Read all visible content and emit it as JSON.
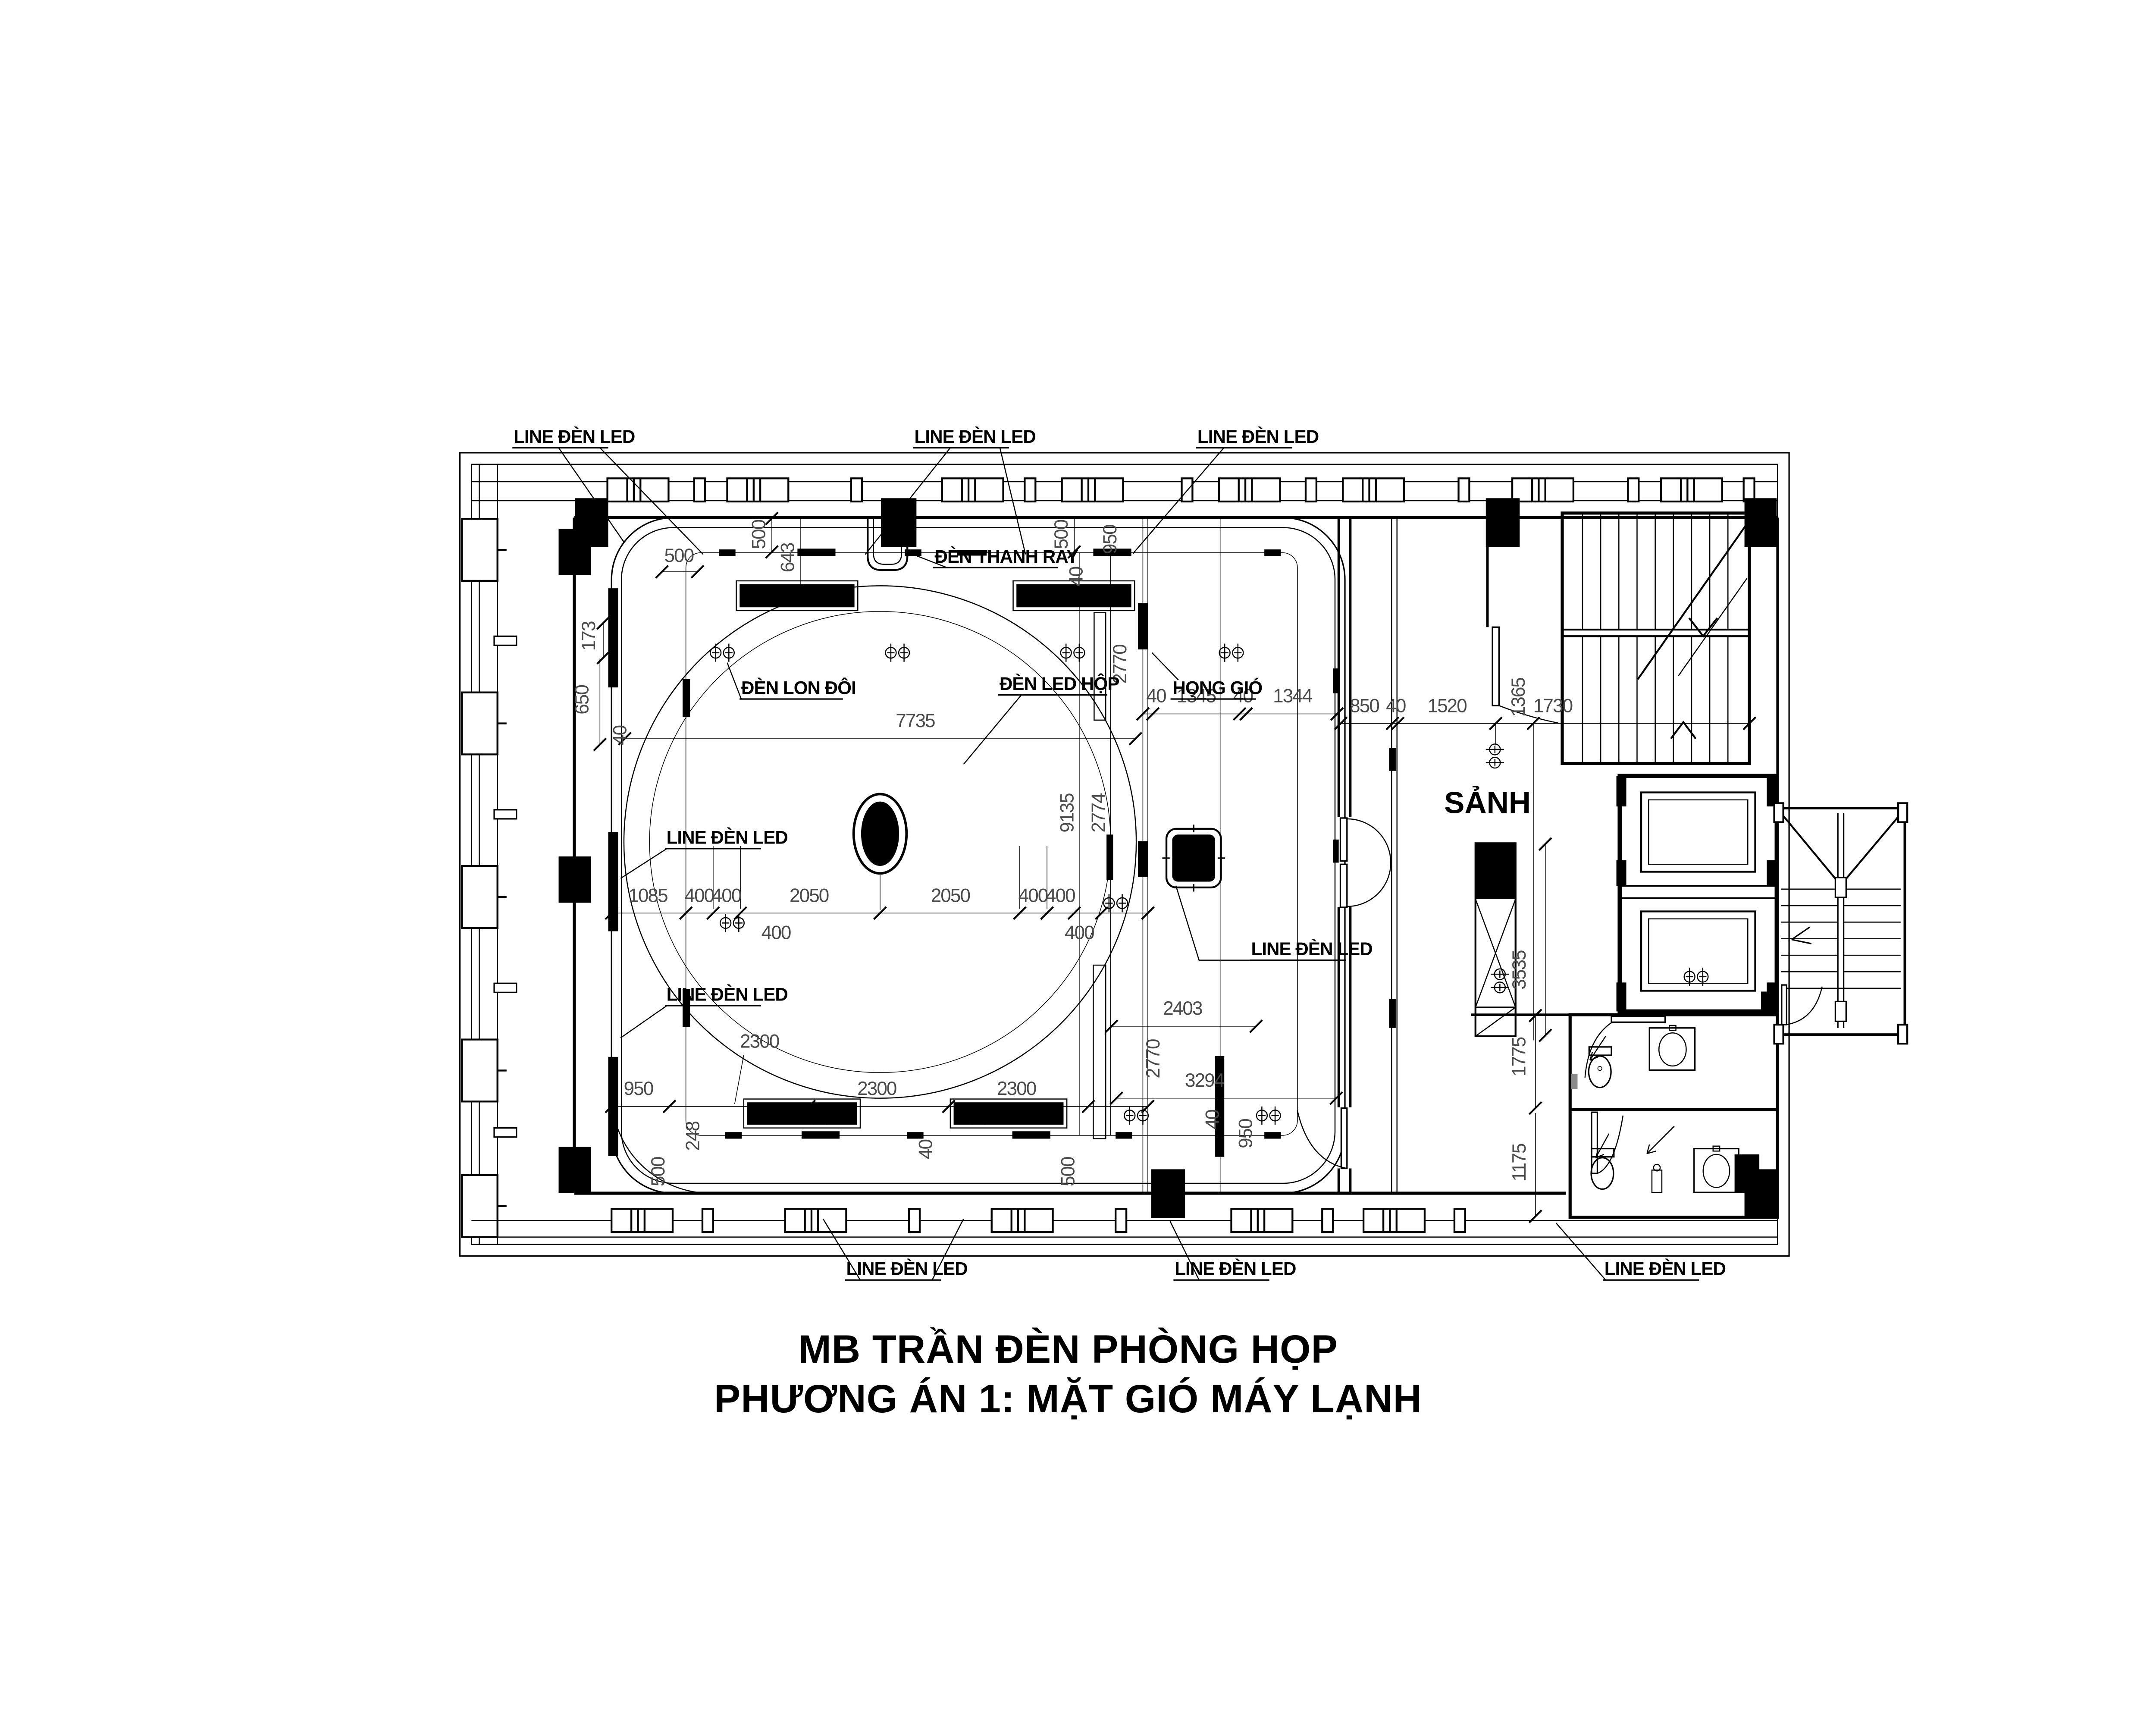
{
  "title": {
    "line1": "MB TRẦN ĐÈN PHÒNG HỌP",
    "line2": "PHƯƠNG ÁN 1: MẶT GIÓ MÁY LẠNH"
  },
  "labels": {
    "line_den_led": "LINE ĐÈN LED",
    "den_thanh_ray": "ĐÈN THANH RAY",
    "den_lon_doi": "ĐÈN LON ĐÔI",
    "den_led_hop": "ĐÈN LED HỘP",
    "hong_gio": "HỌNG GIÓ",
    "sanh": "SẢNH"
  },
  "dims": {
    "v40": "40",
    "v173": "173",
    "v248": "248",
    "v400": "400",
    "v500": "500",
    "v643": "643",
    "v650": "650",
    "v850": "850",
    "v950": "950",
    "v1085": "1085",
    "v1175": "1175",
    "v1344": "1344",
    "v1345": "1345",
    "v1365": "1365",
    "v1520": "1520",
    "v1730": "1730",
    "v1775": "1775",
    "v2050": "2050",
    "v2300": "2300",
    "v2403": "2403",
    "v2770": "2770",
    "v2774": "2774",
    "v3294": "3294",
    "v3535": "3535",
    "v7735": "7735",
    "v9135": "9135"
  },
  "colors": {
    "ink": "#000000",
    "dim_text": "#4a4a4a",
    "paper": "#ffffff"
  }
}
